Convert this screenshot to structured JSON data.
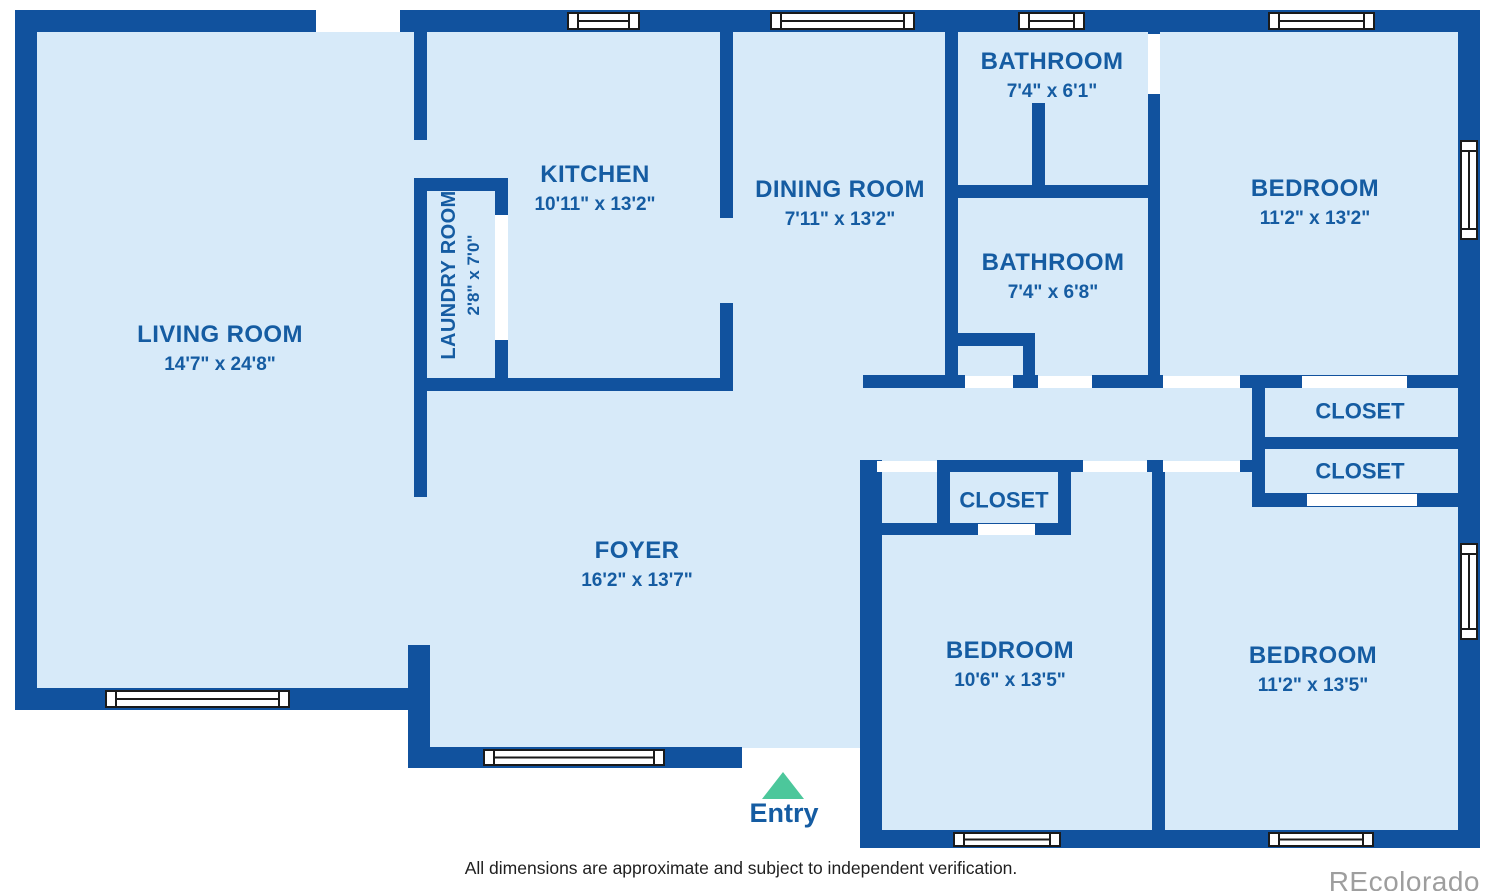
{
  "colors": {
    "wall": "#11529E",
    "floor": "#D7EAF9",
    "room_label": "#155CA2",
    "entry_arrow": "#4CC79B",
    "window_frame": "#1a1a1a",
    "footer_text": "#1f1f1f",
    "watermark": "#9e9e9e"
  },
  "rooms": [
    {
      "name": "LIVING ROOM",
      "dims": "14'7\" x 24'8\""
    },
    {
      "name": "KITCHEN",
      "dims": "10'11\" x 13'2\""
    },
    {
      "name": "LAUNDRY ROOM",
      "dims": "2'8\" x 7'0\""
    },
    {
      "name": "DINING ROOM",
      "dims": "7'11\" x 13'2\""
    },
    {
      "name": "BATHROOM",
      "dims": "7'4\" x 6'1\""
    },
    {
      "name": "BATHROOM",
      "dims": "7'4\" x 6'8\""
    },
    {
      "name": "BEDROOM",
      "dims": "11'2\" x 13'2\""
    },
    {
      "name": "FOYER",
      "dims": "16'2\" x 13'7\""
    },
    {
      "name": "BEDROOM",
      "dims": "10'6\" x 13'5\""
    },
    {
      "name": "BEDROOM",
      "dims": "11'2\" x 13'5\""
    }
  ],
  "closets": [
    "CLOSET",
    "CLOSET",
    "CLOSET"
  ],
  "entry_label": "Entry",
  "footer": "All dimensions are approximate and subject to independent verification.",
  "watermark": "REcolorado"
}
